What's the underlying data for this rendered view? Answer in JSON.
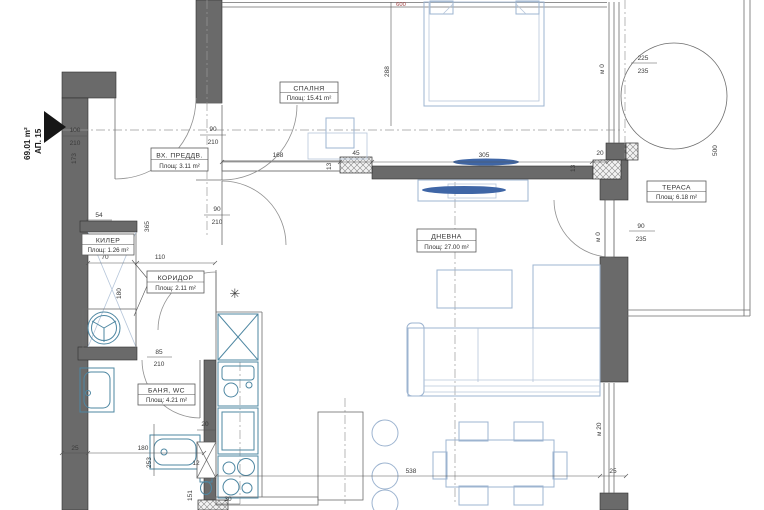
{
  "plan": {
    "apartment_label": "АП. 15",
    "apartment_area": "69.01 m²",
    "rooms": [
      {
        "name": "СПАЛНЯ",
        "area": "Площ: 15.41 m²"
      },
      {
        "name": "ВХ. ПРЕДДВ.",
        "area": "Площ: 3.11 m²"
      },
      {
        "name": "КИЛЕР",
        "area": "Площ: 1.26 m²"
      },
      {
        "name": "КОРИДОР",
        "area": "Площ: 2.11 m²"
      },
      {
        "name": "БАНЯ, WC",
        "area": "Площ: 4.21 m²"
      },
      {
        "name": "ДНЕВНА",
        "area": "Площ: 27.00 m²"
      },
      {
        "name": "ТЕРАСА",
        "area": "Площ: 6.18 m²"
      }
    ],
    "dims": {
      "n600": "600",
      "n288": "288",
      "n225": "225",
      "n235": "235",
      "n500": "500",
      "n168": "168",
      "n45": "45",
      "n305": "305",
      "n13": "13",
      "n20": "20",
      "n90": "90",
      "n210": "210",
      "n100": "100",
      "n173": "173",
      "n365": "365",
      "n54": "54",
      "n70": "70",
      "n110": "110",
      "n180": "180",
      "n85": "85",
      "n253": "253",
      "n151": "151",
      "n12": "12",
      "n30": "30",
      "n25": "25",
      "n538": "538",
      "m0": "м 0",
      "m20": "м 20"
    },
    "symbols": {
      "light": "✳"
    }
  }
}
